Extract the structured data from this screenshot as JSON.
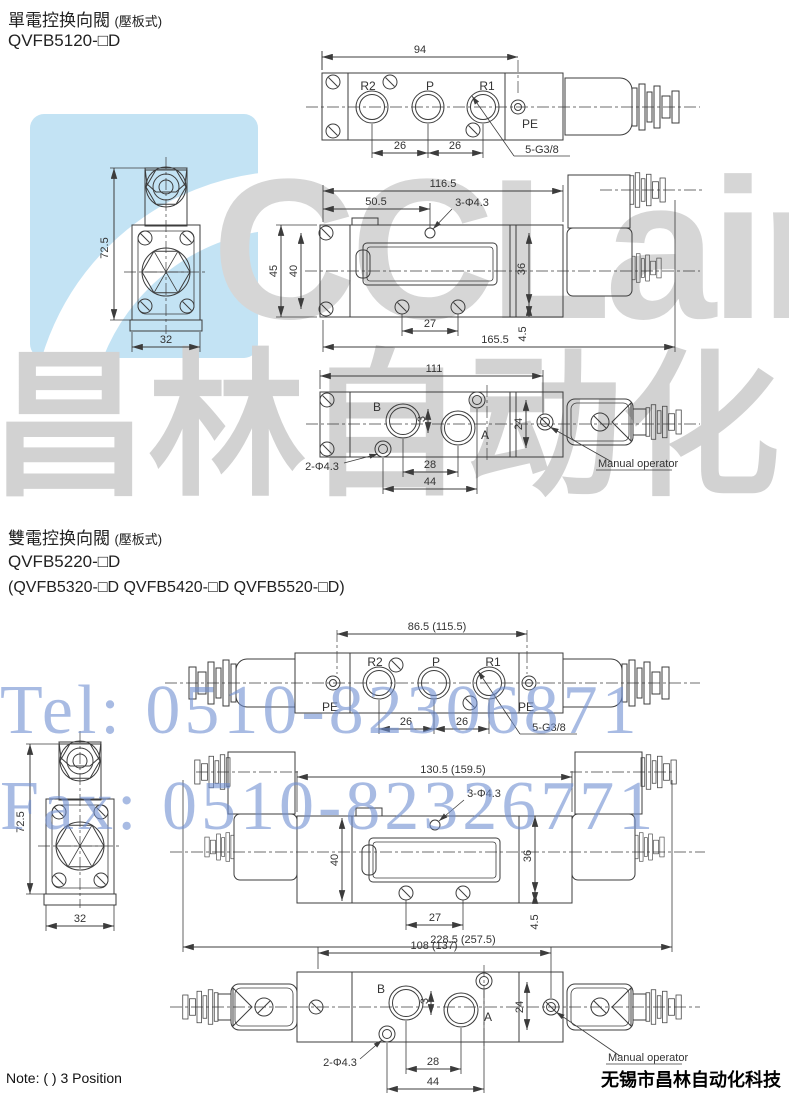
{
  "section1": {
    "title": "單電控换向閥",
    "title_suffix": "(壓板式)",
    "model": "QVFB5120-□D",
    "top_view": {
      "dim_width": "94",
      "port_r2": "R2",
      "port_p": "P",
      "port_r1": "R1",
      "label_pe": "PE",
      "dim_c1": "26",
      "dim_c2": "26",
      "label_thread": "5-G3/8"
    },
    "end_view": {
      "dim_height": "72.5",
      "dim_width": "32"
    },
    "side_view": {
      "dim_w1": "116.5",
      "dim_w2": "50.5",
      "label_holes": "3-Φ4.3",
      "dim_h1": "45",
      "dim_h2": "40",
      "dim_h3": "36",
      "dim_c": "27",
      "dim_h4": "4.5",
      "dim_total": "165.5"
    },
    "bottom_view": {
      "dim_width": "111",
      "port_b": "B",
      "port_a": "A",
      "dim_off": "3",
      "dim_h": "24",
      "dim_c1": "28",
      "dim_c2": "44",
      "label_holes": "2-Φ4.3",
      "label_manual": "Manual operator"
    }
  },
  "section2": {
    "title": "雙電控换向閥",
    "title_suffix": "(壓板式)",
    "model": "QVFB5220-□D",
    "models_alt": "(QVFB5320-□D  QVFB5420-□D  QVFB5520-□D)",
    "top_view": {
      "dim_width": "86.5 (115.5)",
      "port_r2": "R2",
      "port_p": "P",
      "port_r1": "R1",
      "label_pe_left": "PE",
      "label_pe_right": "PE",
      "dim_c1": "26",
      "dim_c2": "26",
      "label_thread": "5-G3/8"
    },
    "end_view": {
      "dim_height": "72.5",
      "dim_width": "32"
    },
    "side_view": {
      "dim_w1": "130.5 (159.5)",
      "label_holes": "3-Φ4.3",
      "dim_h2": "40",
      "dim_h3": "36",
      "dim_c": "27",
      "dim_h4": "4.5",
      "dim_total": "228.5 (257.5)"
    },
    "bottom_view": {
      "dim_width": "108 (137)",
      "port_b": "B",
      "port_a": "A",
      "dim_off": "3",
      "dim_h": "24",
      "dim_c1": "28",
      "dim_c2": "44",
      "label_holes": "2-Φ4.3",
      "label_manual": "Manual operator"
    }
  },
  "watermarks": {
    "logo_text": "CCLair",
    "brand_cn": "昌林自动化",
    "tel": "Tel: 0510-82306871",
    "fax": "Fax: 0510-82326771"
  },
  "footer": {
    "note": "Note: ( ) 3 Position",
    "company": "无锡市昌林自动化科技"
  },
  "colors": {
    "line": "#3c3c3c",
    "watermark_gray": "#d4d4d4",
    "watermark_blue": "#6f8fd2",
    "logo_background": "#c3e3f4"
  }
}
